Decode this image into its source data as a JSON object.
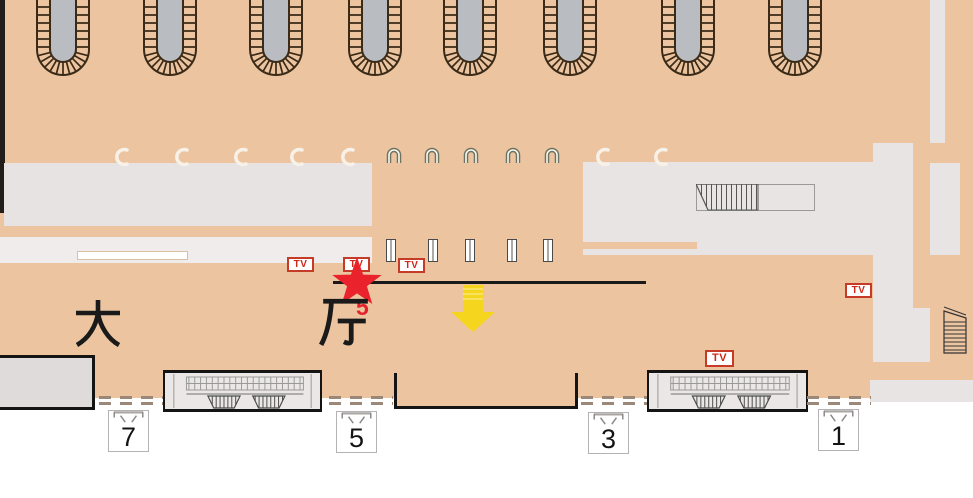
{
  "labels": {
    "hall_char_left": "大",
    "hall_char_right": "厅",
    "star_number": "5",
    "tv": "TV"
  },
  "gates": [
    {
      "number": "7"
    },
    {
      "number": "5"
    },
    {
      "number": "3"
    },
    {
      "number": "1"
    }
  ],
  "icons": {
    "star": "location-star-icon",
    "arrow": "down-arrow-icon",
    "tv_badge": "tv-badge",
    "platform_arch": "platform-arch-icon",
    "escalator": "escalator-icon",
    "stairs": "stairs-icon",
    "gate_funnel": "gate-funnel-icon"
  },
  "colors": {
    "floor": "#ecc5a0",
    "structure": "#e8e4e3",
    "wall": "#1a1a1a",
    "accent_red": "#e8222a",
    "badge_red": "#c53b28",
    "arrow_yellow": "#f6d51f",
    "arch_fill": "#b9bcc0",
    "arch_outline": "#3a2a17"
  }
}
